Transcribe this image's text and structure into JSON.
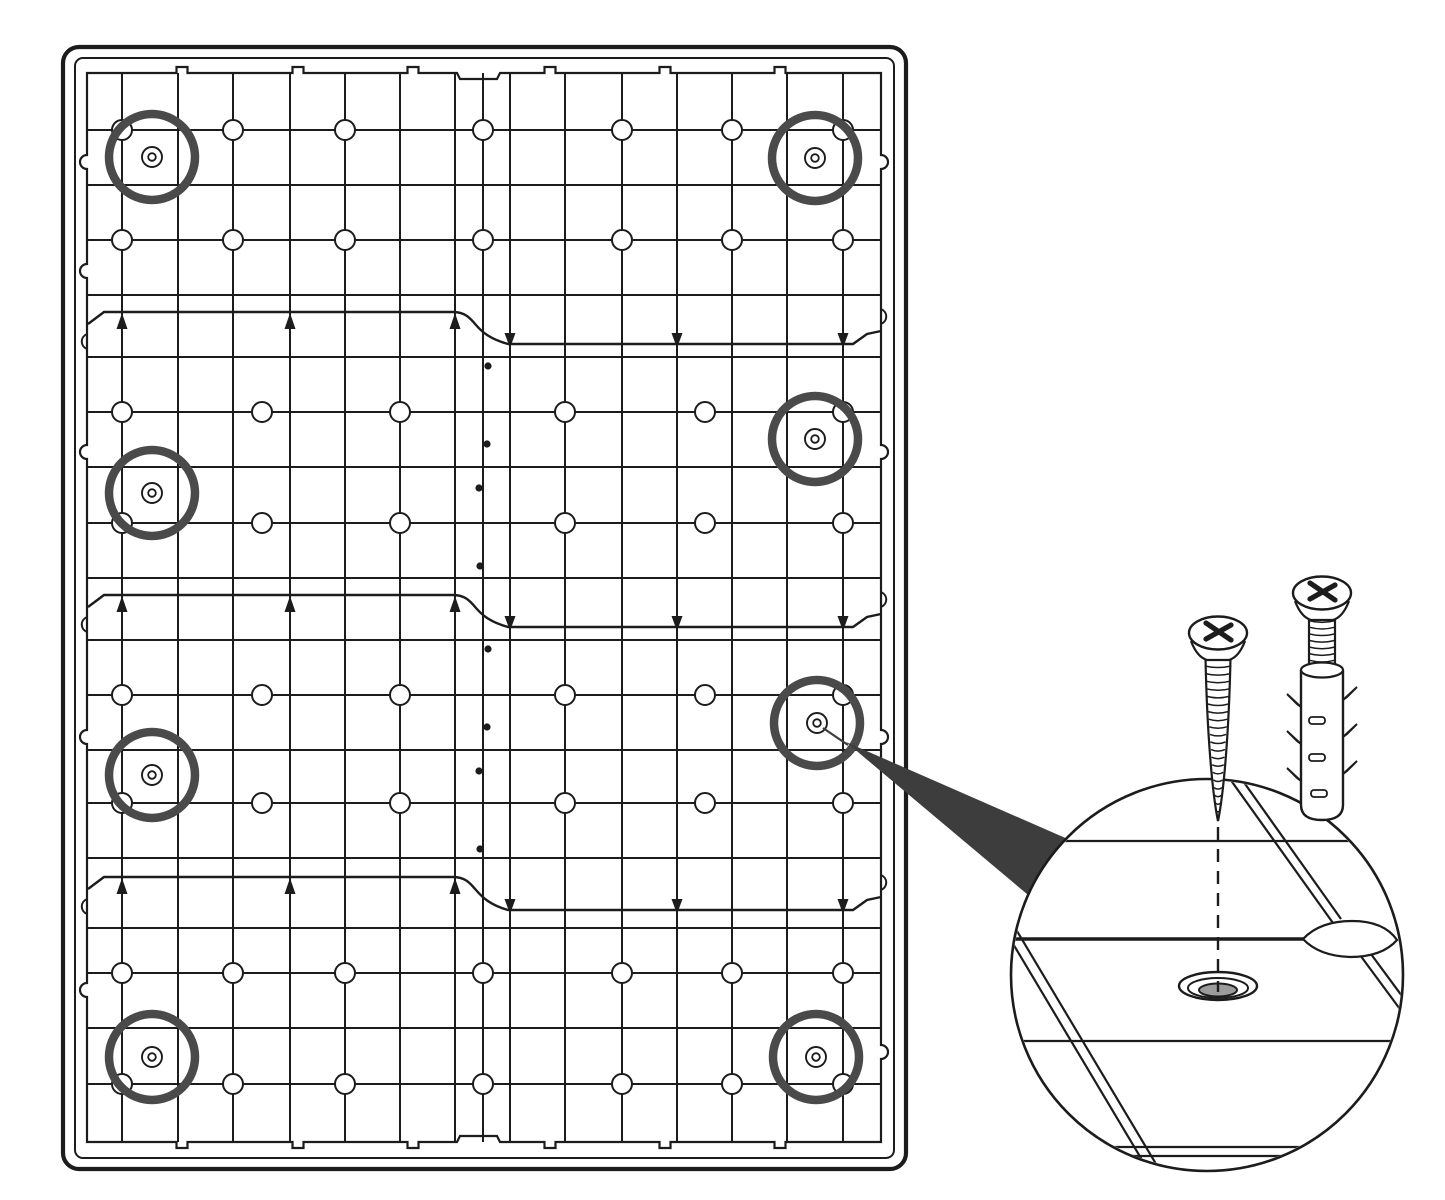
{
  "title": "panel-mounting-instruction-diagram",
  "semantics": {
    "parts": [
      "panel-back-grid",
      "screw-position-marker",
      "drainage-hole",
      "joint-band-arrows",
      "magnifier-callout",
      "countersunk-screw-hole",
      "screw-icon",
      "wall-plug-icon"
    ],
    "screw_positions_count": 8
  },
  "colors": {
    "background": "#ffffff",
    "line": "#1c1c1c",
    "ring": "#4a4a4a",
    "wedge": "#3d3d3d",
    "hole_gray": "#9b9b9b",
    "barb_shade": "#8a8a8a"
  },
  "panel": {
    "outer_frame": {
      "x": 63,
      "y": 47,
      "w": 843,
      "h": 1122,
      "rx": 16,
      "sw": 4.2
    },
    "inner_frame": {
      "x": 75,
      "y": 58,
      "w": 819,
      "h": 1100,
      "rx": 8,
      "sw": 2
    },
    "content": {
      "x": 87,
      "y": 73,
      "x2": 881,
      "y2": 1142,
      "sw": 2.2
    },
    "top_tabs": [
      182,
      298,
      413,
      550,
      665,
      780
    ],
    "bottom_tabs": [
      182,
      298,
      413,
      550,
      665,
      780
    ],
    "center_notch": [
      457,
      500
    ],
    "tab_w": 11,
    "tab_h": 6,
    "notch_depth": 6,
    "left_notches": [
      162,
      271,
      452,
      737,
      990
    ],
    "right_notches": [
      162,
      452,
      737,
      1052
    ]
  },
  "grid": {
    "verticals": [
      122,
      178,
      233,
      290,
      345,
      400,
      455,
      483,
      510,
      565,
      622,
      677,
      732,
      787,
      843
    ],
    "line_sw": 2,
    "hole_r": 10,
    "sections": [
      {
        "rows": [
          130,
          185,
          240,
          295
        ],
        "hole_rows": [
          130,
          240
        ],
        "hole_cols": [
          122,
          233,
          345,
          483,
          622,
          732,
          843
        ]
      },
      {
        "rows": [
          357,
          412,
          467,
          523,
          578
        ],
        "hole_rows": [
          412,
          523
        ],
        "hole_cols": [
          122,
          262,
          400,
          565,
          705,
          843
        ]
      },
      {
        "rows": [
          640,
          695,
          750,
          803,
          858
        ],
        "hole_rows": [
          695,
          803
        ],
        "hole_cols": [
          122,
          262,
          400,
          565,
          705,
          843
        ]
      },
      {
        "rows": [
          928,
          973,
          1028,
          1084
        ],
        "hole_rows": [
          973,
          1084
        ],
        "hole_cols": [
          122,
          233,
          345,
          483,
          622,
          732,
          843
        ]
      }
    ]
  },
  "joint_bands": {
    "bands": [
      {
        "yL": 312,
        "yR": 344
      },
      {
        "yL": 595,
        "yR": 627
      },
      {
        "yL": 877,
        "yR": 910
      }
    ],
    "up_arrows_x": [
      122,
      290,
      455
    ],
    "down_arrows_x": [
      510,
      677,
      843
    ],
    "band_sw": 2.4,
    "seam_x": 483,
    "seam_dots_dx": [
      5,
      4,
      -4,
      -3
    ],
    "seam_dots_dy": [
      22,
      100,
      144,
      222
    ],
    "seam_dot_r": 3.6
  },
  "screw_markers": {
    "ring_r": 43,
    "ring_sw": 8.5,
    "symbol_r_outer": 10,
    "symbol_r_inner": 3.8,
    "centers": [
      [
        152,
        157
      ],
      [
        815,
        158
      ],
      [
        815,
        439
      ],
      [
        152,
        493
      ],
      [
        817,
        723
      ],
      [
        152,
        775
      ],
      [
        152,
        1057
      ],
      [
        816,
        1057
      ]
    ]
  },
  "callout": {
    "line": [
      [
        823,
        728
      ],
      [
        848,
        745
      ]
    ],
    "wedge": [
      [
        846,
        742
      ],
      [
        1070,
        840
      ],
      [
        1040,
        905
      ]
    ]
  },
  "detail_view": {
    "cx": 1207,
    "cy": 975,
    "r": 196,
    "sw": 2.6,
    "plank_lines": [
      {
        "y": 841,
        "sw": 2.2
      },
      {
        "y": 1041,
        "sw": 2.2
      },
      {
        "y": 1147,
        "sw": 2.2
      },
      {
        "y": 1156,
        "sw": 2.2
      }
    ],
    "thick_line": {
      "y": 939,
      "x2": 1310,
      "sw": 3.6
    },
    "diagonals": [
      [
        [
          1003,
          927
        ],
        [
          1157,
          1185
        ]
      ],
      [
        [
          1011,
          921
        ],
        [
          1165,
          1179
        ]
      ],
      [
        [
          1230,
          779
        ],
        [
          1333,
          923
        ]
      ],
      [
        [
          1238,
          774
        ],
        [
          1341,
          919
        ]
      ],
      [
        [
          1360,
          955
        ],
        [
          1408,
          1020
        ]
      ],
      [
        [
          1368,
          950
        ],
        [
          1416,
          1015
        ]
      ]
    ],
    "diag_sw": 2.2,
    "lens_path": "M 1303 939 Q 1320 921 1352 921 Q 1384 921 1397 940 Q 1382 957 1350 957 Q 1319 956 1303 939 Z",
    "hole": {
      "cx": 1218,
      "cy": 986,
      "rx1": 39,
      "ry1": 14,
      "rx2": 30,
      "ry2": 10,
      "gray_cy": 990,
      "gray_rx": 19,
      "gray_ry": 6.5
    },
    "dashed_line": {
      "x": 1218,
      "y1": 827,
      "y2": 992,
      "dash": "13 9",
      "sw": 2.4
    }
  },
  "hardware": {
    "screw_free": {
      "cx": 1218,
      "head_cy": 633,
      "head_rx": 29,
      "head_ry": 16.5,
      "shaft_top": 658,
      "tip_y": 821,
      "shaft_hw": 12.5,
      "threads": 20,
      "thread_gap": 7.6
    },
    "screw_in_plug": {
      "cx": 1322,
      "head_cy": 593,
      "head_rx": 29,
      "head_ry": 16.5,
      "shaft_top": 610,
      "shaft_bot": 668,
      "shaft_hw": 13,
      "threads": 9,
      "thread_gap": 6.6
    },
    "plug": {
      "cx": 1322,
      "top_y": 670,
      "bot_y": 805,
      "hw": 21,
      "top_ry": 7.5,
      "left_barbs": [
        707,
        744,
        781
      ],
      "right_barbs": [
        700,
        737,
        774
      ],
      "slots": [
        [
          1309,
          717
        ],
        [
          1309,
          754
        ],
        [
          1311,
          790
        ]
      ],
      "slot_w": 16,
      "slot_h": 7
    }
  }
}
